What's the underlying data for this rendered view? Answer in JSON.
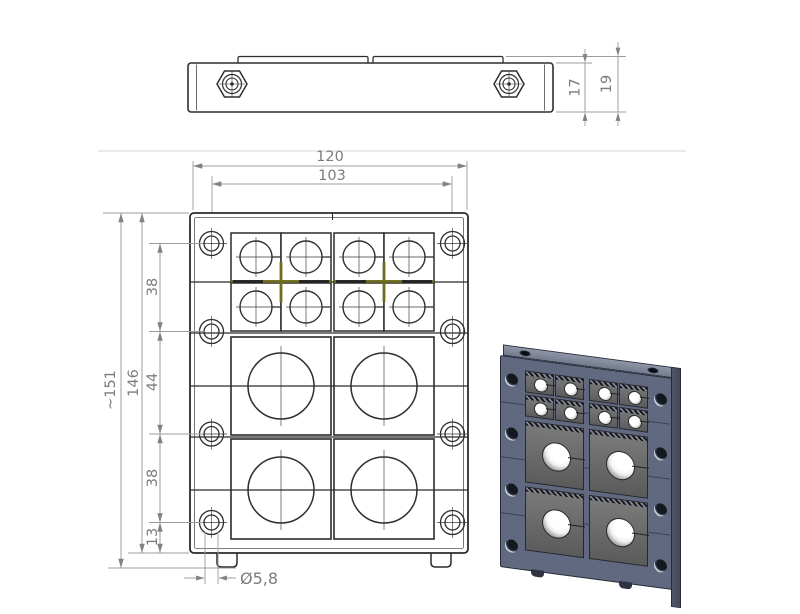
{
  "title": "Cable entry frame – technical drawing",
  "dims": {
    "top": {
      "body_height": "17",
      "total_height": "19"
    },
    "front": {
      "overall_width": "120",
      "mount_hole_span": "103",
      "overall_height": "~151",
      "frame_height": "146",
      "pitch_top": "38",
      "pitch_mid": "44",
      "pitch_bottom": "38",
      "bottom_offset": "13",
      "mount_hole_dia": "Ø5,8"
    }
  },
  "colors": {
    "drawing_line": "#2f2f2f",
    "dimension_gray": "#8a8a8a",
    "accent_olive": "#6f6b1f",
    "render_frame_front": "#616980",
    "render_frame_side": "#4a4f60",
    "render_frame_top": "#848b9d",
    "render_module_gray": "#6e6e6e",
    "render_hole_white": "#f5f5f5"
  }
}
